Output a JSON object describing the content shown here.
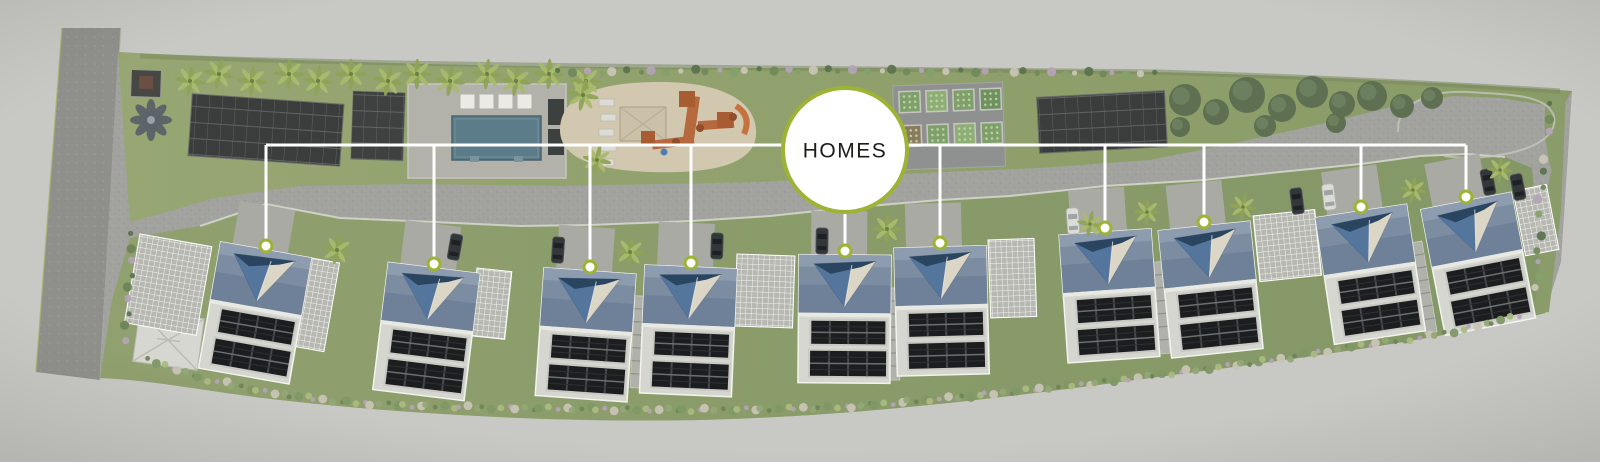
{
  "scene": {
    "type": "aerial-site-plan-rendering",
    "background_color": "#c8c9c4",
    "description": "Aerial master-plan rendering of a residential community: a row of ten solar-roofed homes along a drive, with pool, playground, community garden and solar carports"
  },
  "callout": {
    "label": "HOMES",
    "cx": 845,
    "cy": 150,
    "radius": 62,
    "ring_color": "#9db335",
    "fill_color": "#ffffff",
    "text_color": "#1c1c1a",
    "font_size": 21
  },
  "connectors": {
    "color": "#ffffff",
    "width": 3,
    "trunk_y": 145,
    "trunk_x1": 266,
    "trunk_x2": 1466
  },
  "markers": {
    "icon": "circle-marker",
    "radius": 6,
    "ring_width": 3,
    "ring_color": "#9db335",
    "fill_color": "#ffffff"
  },
  "homes": [
    {
      "id": "home-1",
      "marker_x": 266,
      "marker_y": 246,
      "rotation": 10
    },
    {
      "id": "home-2",
      "marker_x": 434,
      "marker_y": 264,
      "rotation": 7
    },
    {
      "id": "home-3",
      "marker_x": 590,
      "marker_y": 267,
      "rotation": 4
    },
    {
      "id": "home-4",
      "marker_x": 691,
      "marker_y": 263,
      "rotation": 2.5
    },
    {
      "id": "home-5",
      "marker_x": 845,
      "marker_y": 251,
      "rotation": 0.5
    },
    {
      "id": "home-6",
      "marker_x": 940,
      "marker_y": 243,
      "rotation": -1.5
    },
    {
      "id": "home-7",
      "marker_x": 1105,
      "marker_y": 228,
      "rotation": -4
    },
    {
      "id": "home-8",
      "marker_x": 1204,
      "marker_y": 222,
      "rotation": -6
    },
    {
      "id": "home-9",
      "marker_x": 1361,
      "marker_y": 207,
      "rotation": -8.5
    },
    {
      "id": "home-10",
      "marker_x": 1466,
      "marker_y": 197,
      "rotation": -11
    }
  ],
  "home_style": {
    "width": 92,
    "height": 128,
    "roof_blue": "#6e8199",
    "roof_light": "#d5d6d0",
    "solar_black": "#1b1d1f",
    "pyramid_navy": "#2a4560",
    "pyramid_blue": "#54759c",
    "pyramid_cream": "#dbd6c5"
  },
  "environment_colors": {
    "pavement": "#a2a39e",
    "road": "#8f908c",
    "lawn": "#93a371",
    "pool_water": "#5d7c89",
    "sand": "#d2c8b0",
    "play_equipment_orange": "#b6693c",
    "tree_canopy": "#5e7051",
    "solar_canopy": "#3a3d3c"
  }
}
